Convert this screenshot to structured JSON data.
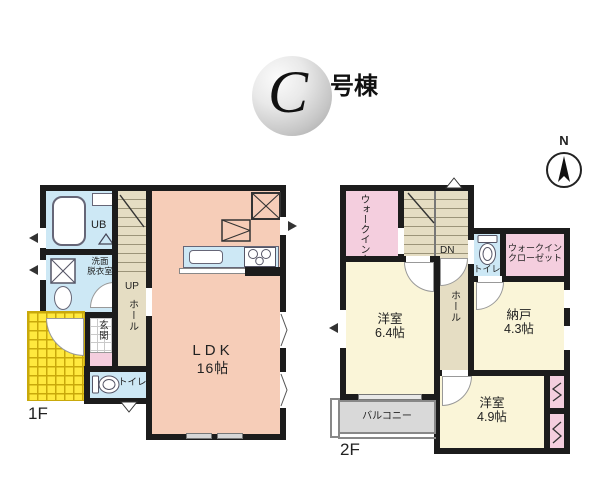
{
  "title": {
    "letter": "C",
    "suffix": "号棟"
  },
  "compass": {
    "north": "N"
  },
  "floor1": {
    "label": "1F",
    "ub": "UB",
    "washroom_l1": "洗面",
    "washroom_l2": "脱衣室",
    "up": "UP",
    "hall": "ホール",
    "genkan": "玄関",
    "toilet": "トイレ",
    "ldk_name": "LDK",
    "ldk_size": "16帖"
  },
  "floor2": {
    "label": "2F",
    "wic_left": "ウォークインクローゼット",
    "dn": "DN",
    "toilet": "トイレ",
    "wic_right_l1": "ウォークイン",
    "wic_right_l2": "クローゼット",
    "hall": "ホール",
    "bed1_name": "洋室",
    "bed1_size": "6.4帖",
    "storage_name": "納戸",
    "storage_size": "4.3帖",
    "bed2_name": "洋室",
    "bed2_size": "4.9帖",
    "balcony": "バルコニー"
  },
  "colors": {
    "wall": "#1c1c1c",
    "ldk": "#f6cdb8",
    "water": "#cde8f5",
    "beige": "#e5ddc3",
    "pink": "#f4cede",
    "cream": "#faf5d8",
    "porch": "#ffe93e",
    "balcony": "#d9d9d9"
  }
}
